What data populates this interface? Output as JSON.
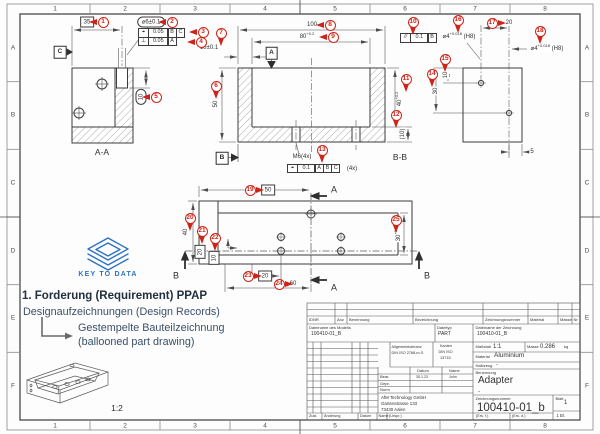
{
  "border": {
    "cols": [
      "1",
      "2",
      "3",
      "4",
      "5",
      "6",
      "7",
      "8"
    ],
    "rows": [
      "A",
      "B",
      "C",
      "D",
      "E",
      "F"
    ]
  },
  "logo": {
    "text": "KEY TO DATA"
  },
  "ppap": {
    "heading": "1. Forderung (Requirement) PPAP",
    "design_records": "Designaufzeichnungen (Design Records)",
    "stamped_1": "Gestempelte Bauteilzeichnung",
    "stamped_2": "(ballooned part drawing)"
  },
  "fcf": {
    "aa_row1": [
      "⌖",
      "0.05",
      "B",
      "C"
    ],
    "aa_row2": [
      "⊥",
      "0.05",
      "A"
    ],
    "bb_row": [
      "⌖",
      "0.1",
      "A",
      "B",
      "C"
    ],
    "parallel_row": [
      "//",
      "0.1",
      "B"
    ]
  },
  "balloons": [
    {
      "n": "1",
      "x": 103,
      "y": 22,
      "d": "w"
    },
    {
      "n": "2",
      "x": 172,
      "y": 22,
      "d": "w"
    },
    {
      "n": "3",
      "x": 203,
      "y": 32,
      "d": "w"
    },
    {
      "n": "4",
      "x": 201,
      "y": 42,
      "d": "w"
    },
    {
      "n": "5",
      "x": 156,
      "y": 97,
      "d": "w"
    },
    {
      "n": "6",
      "x": 216,
      "y": 86,
      "d": "s"
    },
    {
      "n": "7",
      "x": 221,
      "y": 33,
      "d": "s"
    },
    {
      "n": "8",
      "x": 330,
      "y": 25,
      "d": "w"
    },
    {
      "n": "9",
      "x": 333,
      "y": 37,
      "d": "w"
    },
    {
      "n": "10",
      "x": 413,
      "y": 22,
      "d": "s"
    },
    {
      "n": "11",
      "x": 406,
      "y": 79,
      "d": "s"
    },
    {
      "n": "12",
      "x": 396,
      "y": 115,
      "d": "s"
    },
    {
      "n": "13",
      "x": 322,
      "y": 150,
      "d": "s"
    },
    {
      "n": "14",
      "x": 432,
      "y": 74,
      "d": "s"
    },
    {
      "n": "15",
      "x": 445,
      "y": 59,
      "d": "s"
    },
    {
      "n": "16",
      "x": 458,
      "y": 20,
      "d": "s"
    },
    {
      "n": "17",
      "x": 492,
      "y": 23,
      "d": "e"
    },
    {
      "n": "18",
      "x": 540,
      "y": 31,
      "d": "s"
    },
    {
      "n": "19",
      "x": 250,
      "y": 190,
      "d": "e"
    },
    {
      "n": "20",
      "x": 190,
      "y": 218,
      "d": "s"
    },
    {
      "n": "21",
      "x": 202,
      "y": 231,
      "d": "s"
    },
    {
      "n": "22",
      "x": 215,
      "y": 238,
      "d": "s"
    },
    {
      "n": "23",
      "x": 248,
      "y": 276,
      "d": "e"
    },
    {
      "n": "24",
      "x": 279,
      "y": 284,
      "d": "e"
    },
    {
      "n": "25",
      "x": 396,
      "y": 220,
      "d": "s"
    }
  ],
  "dims": [
    {
      "t": "35",
      "x": 87,
      "y": 22,
      "box": "rect"
    },
    {
      "t": "⌀6±0.1",
      "x": 151,
      "y": 22,
      "box": "round"
    },
    {
      "t": "10",
      "x": 141,
      "y": 97,
      "box": "round",
      "rot": true
    },
    {
      "t": "10±0.1",
      "x": 209,
      "y": 48
    },
    {
      "t": "100",
      "x": 312,
      "y": 25
    },
    {
      "t": "80",
      "sup": "+0.2",
      "x": 307,
      "y": 37
    },
    {
      "t": "50",
      "x": 216,
      "y": 104,
      "rot": true
    },
    {
      "t": "40",
      "sup": "+0.2",
      "x": 400,
      "y": 99,
      "rot": true
    },
    {
      "t": "(10)",
      "x": 403,
      "y": 134,
      "rot": true
    },
    {
      "t": "M6(4x)",
      "x": 302,
      "y": 157
    },
    {
      "t": "(4x)",
      "x": 352,
      "y": 169
    },
    {
      "t": "⌀4",
      "sup": "+0.018",
      "suf": " (H8)",
      "x": 459,
      "y": 37
    },
    {
      "t": "20",
      "x": 509,
      "y": 23
    },
    {
      "t": "⌀4",
      "sup": "+0.018",
      "suf": " (H8)",
      "x": 547,
      "y": 49
    },
    {
      "t": "10",
      "x": 446,
      "y": 75,
      "rot": true
    },
    {
      "t": "30",
      "x": 436,
      "y": 91,
      "rot": true
    },
    {
      "t": "5",
      "x": 532,
      "y": 152
    },
    {
      "t": "50",
      "x": 268,
      "y": 190,
      "box": "rect"
    },
    {
      "t": "40",
      "x": 186,
      "y": 232,
      "rot": true
    },
    {
      "t": "20",
      "x": 200,
      "y": 252,
      "box": "rect",
      "rot": true
    },
    {
      "t": "10",
      "x": 214,
      "y": 258,
      "box": "rect",
      "rot": true
    },
    {
      "t": "20",
      "x": 265,
      "y": 276,
      "box": "rect"
    },
    {
      "t": "60",
      "x": 293,
      "y": 284
    },
    {
      "t": "30",
      "sup": "+0.2",
      "x": 399,
      "y": 234,
      "rot": true
    },
    {
      "t": "A-A",
      "x": 102,
      "y": 152,
      "cls": "vl",
      "name": "view-label-aa"
    },
    {
      "t": "B-B",
      "x": 400,
      "y": 157,
      "cls": "vl",
      "name": "view-label-bb"
    },
    {
      "t": "1:2",
      "x": 117,
      "y": 408,
      "cls": "vl",
      "name": "iso-scale-label"
    },
    {
      "t": "A",
      "x": 334,
      "y": 190,
      "cls": "sec",
      "name": "section-label-a-top"
    },
    {
      "t": "A",
      "x": 334,
      "y": 288,
      "cls": "sec",
      "name": "section-label-a-bottom"
    },
    {
      "t": "B",
      "x": 176,
      "y": 276,
      "cls": "sec",
      "name": "section-label-b-left"
    },
    {
      "t": "B",
      "x": 427,
      "y": 276,
      "cls": "sec",
      "name": "section-label-b-right"
    },
    {
      "t": "C",
      "x": 60,
      "y": 52,
      "box": "datum",
      "name": "datum-c"
    },
    {
      "t": "A",
      "x": 271.5,
      "y": 53,
      "box": "datum",
      "name": "datum-a"
    },
    {
      "t": "B",
      "x": 222,
      "y": 158,
      "box": "datum",
      "name": "datum-b"
    }
  ],
  "titleblock": {
    "parts_header": [
      "IDNR",
      "Anz",
      "Benennung",
      "Bezeichnung",
      "Zeichnungsnummer",
      "Material",
      "Masse",
      "Nr"
    ],
    "file_model_label": "Dateiname des Modells",
    "file_model": "100410-01_B",
    "filetype_label": "Dateityp",
    "filetype": "PART",
    "file_drawing_label": "Dateiname der Zeichnung",
    "file_drawing": "100410-01_B",
    "gen_tol_1": "Allgemeintoleranz",
    "gen_tol_2": "DIN ISO 2768-m-S",
    "edges_1": "Kanten",
    "edges_2": "DIN ISO",
    "edges_3": "13715",
    "scale_label": "Maßstab",
    "scale": "1:1",
    "mass_label": "Masse",
    "mass": "0.286",
    "mass_unit": "kg",
    "material_label": "Material",
    "material": "Aluminium",
    "stock_label": "Halbzeug",
    "stock": "-",
    "col_date": "Datum",
    "col_name": "Name",
    "row_bear": "Bear.",
    "bear_date": "30.1.23",
    "bear_name": "John",
    "row_gepr": "Gepr.",
    "row_norm": "Norm",
    "name_label": "Benennung",
    "part_name": "Adapter",
    "part_name_2": "-",
    "company_1": "AfM Technology GmbH",
    "company_2": "Gartenstrasse 133",
    "company_3": "73430 Aalen",
    "number_label": "Zeichnungsnummer",
    "drawing_number": "100410-01_b",
    "sheet_label": "Blatt",
    "sheet_no": "1",
    "sheet_count": "1 Bl.",
    "rev_cols": [
      "Zust.",
      "Änderung",
      "Datum",
      "Name"
    ],
    "origin_label": "(Urspr.)",
    "replaces_label": "(Ers. f.)",
    "replaced_by_label": "(Ers. d.)"
  }
}
